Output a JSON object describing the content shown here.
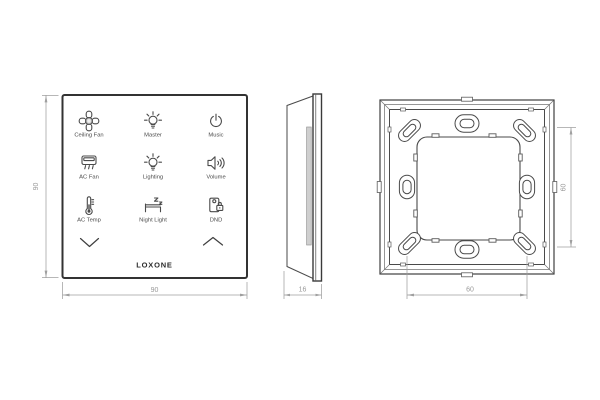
{
  "front_view": {
    "buttons": [
      {
        "label": "Ceiling Fan",
        "icon": "ceiling-fan-icon"
      },
      {
        "label": "Master",
        "icon": "light-bulb-icon"
      },
      {
        "label": "Music",
        "icon": "power-icon"
      },
      {
        "label": "AC Fan",
        "icon": "air-conditioner-icon"
      },
      {
        "label": "Lighting",
        "icon": "light-bulb-icon"
      },
      {
        "label": "Volume",
        "icon": "speaker-icon"
      },
      {
        "label": "AC Temp",
        "icon": "thermometer-icon"
      },
      {
        "label": "Night Light",
        "icon": "bed-icon"
      },
      {
        "label": "DND",
        "icon": "door-hanger-lock-icon"
      }
    ],
    "nav": {
      "down": "chevron-down-icon",
      "up": "chevron-up-icon"
    },
    "brand": "LOXONE"
  },
  "dimensions": {
    "front_width": "90",
    "front_height": "90",
    "side_depth": "16",
    "back_hole_spacing_h": "60",
    "back_hole_spacing_v": "60"
  },
  "colors": {
    "line": "#3f3f3f",
    "dimension": "#9f9f9f",
    "background": "#ffffff"
  }
}
